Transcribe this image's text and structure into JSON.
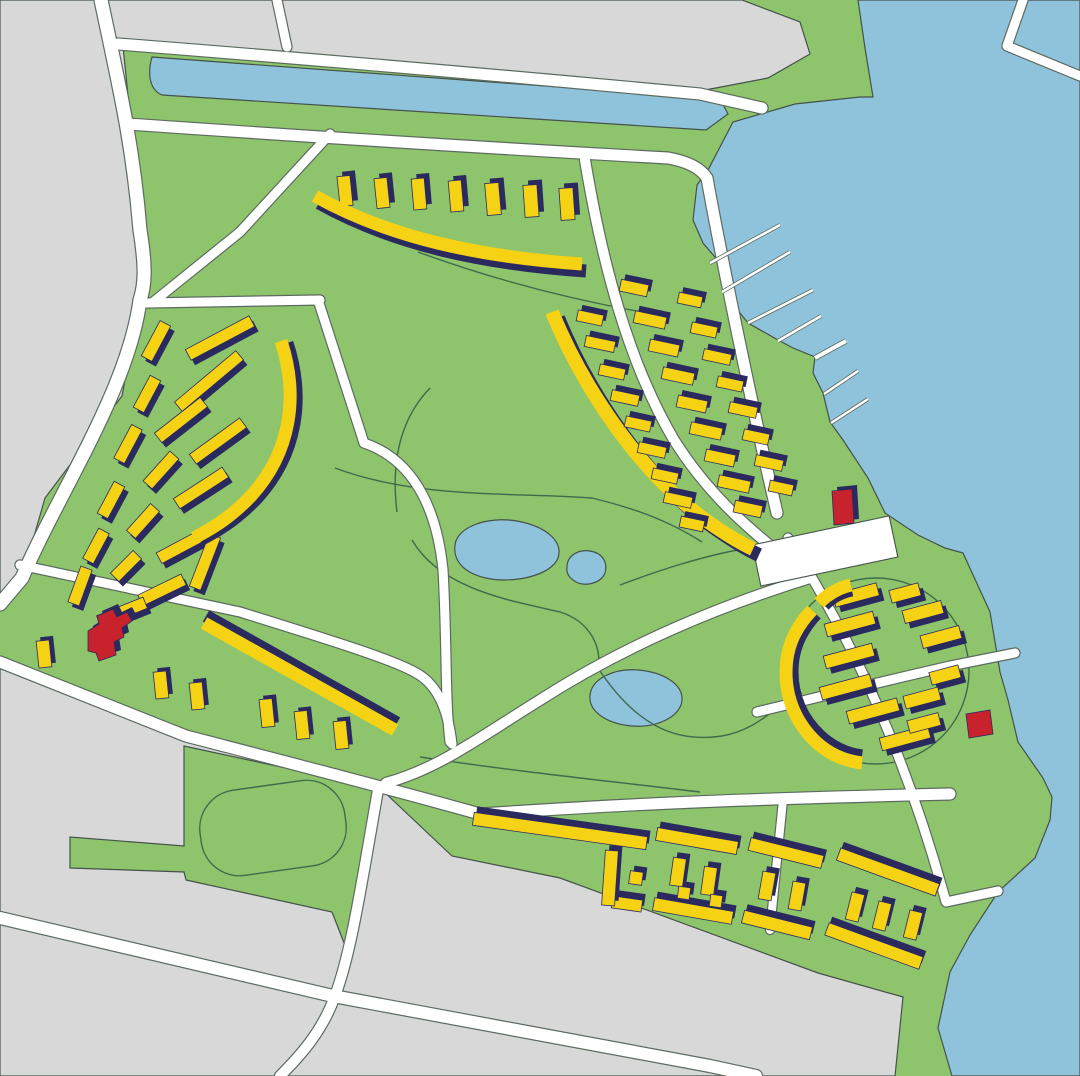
{
  "map": {
    "kind": "masterplan-illustration",
    "colors": {
      "parkland": "#8DC46C",
      "urban_block": "#D8D8D8",
      "water": "#8FC3DC",
      "road_fill": "#FFFFFF",
      "road_casing": "#5C6B5F",
      "outline": "#44524A",
      "trail": "#3F6B4D",
      "building_fill": "#F6D215",
      "building_shadow": "#2B2A5F",
      "landmark_red": "#C8232C",
      "plaza": "#FFFFFF"
    },
    "regions": {
      "urban_blocks": [
        "M0,0 L742,0 L800,22 L810,54 L768,78 L700,91 L123,46 L133,145 L141,240 L140,300 L122,396 L45,498 L22,578 L0,604 Z",
        "M967,0 L1080,0 L1080,162 Z",
        "M0,668 L186,738 L380,788 L452,856 L560,878 L818,973 L903,997 L895,1076 L0,1076 Z"
      ],
      "water_bodies": [
        "M858,0 L1080,0 L1080,1076 L952,1076 L938,1028 L950,972 L970,935 L998,892 L1035,858 L1050,820 L1052,797 L1043,778 L1018,742 L1008,700 L1000,672 L990,612 L963,553 L945,548 L918,535 L885,513 L868,478 L843,440 L830,422 L823,393 L813,373 L815,357 L793,348 L778,340 L748,323 L723,292 L720,263 L703,243 L693,220 L697,185 L708,170 L733,122 L795,104 L860,97 L873,97 L865,48 Z",
        "M152,57 L720,99 L728,114 L706,130 L162,95 C150,90 147,75 152,57 Z"
      ],
      "ponds": [
        "M455,545 C457,527 487,516 517,521 C549,527 563,543 558,558 C551,576 512,584 486,578 C463,573 453,560 455,545 Z",
        "M567,567 C567,556 578,549 590,551 C603,553 608,563 605,573 C601,583 586,587 576,582 C569,578 566,573 567,567 Z",
        "M590,695 C592,678 615,668 638,670 C663,672 683,684 682,700 C681,716 658,728 632,726 C608,724 588,712 590,695 Z"
      ],
      "track_field": "M184,746 L378,788 L360,884 L346,948 L332,912 L186,880 L184,872 L70,868 L70,837 L184,846 Z",
      "track_oval": {
        "cx": 273,
        "cy": 828,
        "rx": 73,
        "ry": 43,
        "rot": -8
      },
      "cluster_circle": {
        "cx": 876,
        "cy": 671,
        "r": 93
      }
    },
    "roads": [
      {
        "d": "M101,0 C120,90 133,145 140,230 C146,268 145,285 140,300 C128,390 60,490 22,578 L0,604",
        "w": 13
      },
      {
        "d": "M118,44 Q400,66 700,94 L762,108",
        "w": 11
      },
      {
        "d": "M128,124 Q400,143 668,158 Q697,163 707,178 C718,240 743,362 763,452 L777,513",
        "w": 11
      },
      {
        "d": "M277,0 L287,47",
        "w": 9
      },
      {
        "d": "M1023,0 L1007,46 L1080,76",
        "w": 9
      },
      {
        "d": "M330,134 L240,232 L152,303",
        "w": 9
      },
      {
        "d": "M146,303 L320,300",
        "w": 9
      },
      {
        "d": "M318,300 L364,443",
        "w": 9
      },
      {
        "d": "M364,443 C420,462 438,520 443,570 C447,640 445,700 450,742",
        "w": 9
      },
      {
        "d": "M20,565 L240,612 C330,640 395,660 418,674 C438,686 448,710 452,744",
        "w": 9
      },
      {
        "d": "M386,783 C440,768 480,737 540,700 C610,655 700,612 810,578",
        "w": 10
      },
      {
        "d": "M0,662 L186,736 C290,763 380,786 480,814 C600,806 700,800 950,794",
        "w": 11
      },
      {
        "d": "M378,790 C362,880 352,950 335,996 C322,1032 300,1056 280,1076",
        "w": 10
      },
      {
        "d": "M0,918 L333,996 L710,1066 L756,1076",
        "w": 12
      },
      {
        "d": "M788,538 C802,560 815,582 830,610 C865,672 910,770 946,902 L998,891",
        "w": 9
      },
      {
        "d": "M757,712 Q880,682 950,666 L1015,653",
        "w": 9
      },
      {
        "d": "M783,800 L770,930",
        "w": 8
      },
      {
        "d": "M585,160 C602,262 628,362 674,440 C708,494 748,528 778,552",
        "w": 10
      }
    ],
    "trails": [
      "M335,468 C420,500 520,492 592,498 C650,512 680,528 702,542",
      "M397,512 C390,455 404,415 430,388",
      "M412,540 C442,592 520,602 560,612 C592,622 602,650 598,668",
      "M598,668 C640,732 682,742 722,736 C760,729 775,705 802,693",
      "M620,585 C660,570 702,556 748,548",
      "M420,757 C520,772 600,780 700,792",
      "M418,252 C500,282 575,300 642,312"
    ],
    "piers": [
      {
        "x1": 710,
        "y1": 263,
        "x2": 780,
        "y2": 225,
        "w": 2.5
      },
      {
        "x1": 722,
        "y1": 292,
        "x2": 790,
        "y2": 252,
        "w": 2.5
      },
      {
        "x1": 748,
        "y1": 323,
        "x2": 813,
        "y2": 290,
        "w": 2.5
      },
      {
        "x1": 778,
        "y1": 341,
        "x2": 821,
        "y2": 316,
        "w": 2.5
      },
      {
        "x1": 815,
        "y1": 358,
        "x2": 846,
        "y2": 341,
        "w": 4
      },
      {
        "x1": 824,
        "y1": 394,
        "x2": 858,
        "y2": 371,
        "w": 2.5
      },
      {
        "x1": 831,
        "y1": 423,
        "x2": 868,
        "y2": 399,
        "w": 2.5
      }
    ],
    "plaza": {
      "cx": 825,
      "cy": 551,
      "w": 140,
      "h": 42,
      "rot": -12
    },
    "building_groups": [
      {
        "name": "north-towers",
        "kind": "rects",
        "dx": 5,
        "dy": -5,
        "rects": [
          [
            345,
            191,
            13,
            30,
            -6
          ],
          [
            382,
            193,
            13,
            30,
            -6
          ],
          [
            419,
            194,
            13,
            31,
            -5
          ],
          [
            456,
            196,
            13,
            31,
            -5
          ],
          [
            493,
            199,
            14,
            32,
            -5
          ],
          [
            531,
            201,
            14,
            32,
            -4
          ],
          [
            567,
            204,
            14,
            32,
            -4
          ]
        ]
      },
      {
        "name": "north-curved-slab",
        "kind": "dualpath",
        "w": 13,
        "shadow": "M319,203 C394,245 484,264 586,271",
        "main": "M315,196 C390,238 480,257 582,264"
      },
      {
        "name": "west-slabs",
        "kind": "rects",
        "dx": 4,
        "dy": 5,
        "rects": [
          [
            156,
            341,
            40,
            12,
            -62
          ],
          [
            220,
            338,
            72,
            12,
            -28
          ],
          [
            209,
            381,
            80,
            12,
            -40
          ],
          [
            147,
            394,
            36,
            12,
            -62
          ],
          [
            181,
            420,
            58,
            12,
            -38
          ],
          [
            218,
            441,
            62,
            12,
            -36
          ],
          [
            128,
            444,
            38,
            12,
            -62
          ],
          [
            161,
            470,
            40,
            12,
            -48
          ],
          [
            201,
            488,
            58,
            12,
            -33
          ],
          [
            111,
            500,
            36,
            12,
            -62
          ],
          [
            143,
            521,
            36,
            12,
            -48
          ],
          [
            182,
            546,
            52,
            12,
            -28
          ],
          [
            96,
            546,
            34,
            12,
            -62
          ],
          [
            126,
            566,
            32,
            12,
            -45
          ],
          [
            162,
            590,
            48,
            12,
            -26
          ],
          [
            80,
            586,
            38,
            12,
            -70
          ],
          [
            122,
            612,
            50,
            12,
            -22
          ],
          [
            205,
            562,
            56,
            12,
            -69
          ]
        ]
      },
      {
        "name": "west-curved-slab",
        "kind": "dualpath",
        "w": 13,
        "shadow": "M287,343 C305,398 297,454 257,498 C233,523 213,533 200,540",
        "main": "M281,341 C299,396 291,452 251,496 C227,521 207,531 194,538"
      },
      {
        "name": "west-towers",
        "kind": "rects",
        "dx": 4,
        "dy": -4,
        "rects": [
          [
            44,
            654,
            13,
            27,
            -6
          ],
          [
            161,
            685,
            13,
            27,
            -6
          ],
          [
            197,
            696,
            13,
            27,
            -6
          ],
          [
            267,
            713,
            13,
            28,
            -6
          ],
          [
            302,
            725,
            13,
            28,
            -6
          ],
          [
            341,
            735,
            13,
            28,
            -6
          ]
        ]
      },
      {
        "name": "west-long-slab",
        "kind": "dualpath",
        "w": 13,
        "shadow": "M206,616 L397,723",
        "main": "M204,623 L395,730"
      },
      {
        "name": "mid-curved-slab",
        "kind": "dualpath",
        "w": 14,
        "shadow": "M558,318 C591,398 646,476 706,522 C728,538 746,549 759,555",
        "main": "M552,312 C585,392 640,470 700,516 C722,532 740,543 753,549"
      },
      {
        "name": "mid-houses",
        "kind": "rects",
        "dx": 4,
        "dy": -5,
        "rects": [
          [
            590,
            318,
            26,
            11,
            12
          ],
          [
            600,
            344,
            30,
            11,
            12
          ],
          [
            612,
            372,
            26,
            11,
            12
          ],
          [
            625,
            398,
            28,
            11,
            12
          ],
          [
            638,
            424,
            26,
            11,
            12
          ],
          [
            652,
            450,
            28,
            11,
            12
          ],
          [
            665,
            476,
            26,
            11,
            12
          ],
          [
            678,
            500,
            28,
            11,
            12
          ],
          [
            692,
            524,
            24,
            11,
            12
          ],
          [
            634,
            288,
            28,
            12,
            12
          ],
          [
            650,
            320,
            32,
            12,
            12
          ],
          [
            664,
            348,
            30,
            12,
            12
          ],
          [
            678,
            376,
            32,
            12,
            12
          ],
          [
            692,
            404,
            30,
            12,
            12
          ],
          [
            706,
            431,
            32,
            12,
            12
          ],
          [
            720,
            458,
            30,
            12,
            12
          ],
          [
            734,
            484,
            32,
            12,
            12
          ],
          [
            748,
            509,
            28,
            12,
            12
          ],
          [
            690,
            300,
            24,
            11,
            12
          ],
          [
            704,
            330,
            26,
            11,
            12
          ],
          [
            717,
            357,
            28,
            11,
            12
          ],
          [
            730,
            384,
            26,
            11,
            12
          ],
          [
            743,
            410,
            28,
            11,
            12
          ],
          [
            756,
            437,
            26,
            11,
            12
          ],
          [
            769,
            463,
            28,
            11,
            12
          ],
          [
            781,
            488,
            24,
            11,
            12
          ]
        ]
      },
      {
        "name": "circle-houses",
        "kind": "rects",
        "dx": 5,
        "dy": 5,
        "rects": [
          [
            856,
            595,
            45,
            13,
            -15
          ],
          [
            905,
            593,
            30,
            13,
            -15
          ],
          [
            850,
            624,
            50,
            13,
            -15
          ],
          [
            923,
            612,
            40,
            13,
            -15
          ],
          [
            849,
            656,
            50,
            13,
            -15
          ],
          [
            941,
            637,
            40,
            13,
            -15
          ],
          [
            846,
            687,
            52,
            13,
            -15
          ],
          [
            945,
            675,
            30,
            13,
            -15
          ],
          [
            873,
            711,
            52,
            13,
            -15
          ],
          [
            922,
            698,
            36,
            13,
            -15
          ],
          [
            905,
            738,
            50,
            13,
            -15
          ],
          [
            924,
            723,
            32,
            13,
            -15
          ]
        ]
      },
      {
        "name": "circle-arc-slab-top",
        "kind": "dualpath",
        "w": 13,
        "shadow": "M852,590 C841,592 832,597 824,605",
        "main": "M851,585 C838,588 828,594 819,603"
      },
      {
        "name": "circle-arc-slab-main",
        "kind": "dualpath",
        "w": 13,
        "shadow": "M816,614 C799,632 792,651 792,671 C792,697 802,719 820,736 C833,748 847,754 862,756",
        "main": "M812,610 C793,630 786,650 786,672 C786,700 797,724 816,742 C830,755 845,761 862,763"
      },
      {
        "name": "south-slabs",
        "kind": "rects",
        "dx": 3,
        "dy": -6,
        "rects": [
          [
            560,
            831,
            175,
            13,
            8
          ],
          [
            627,
            904,
            30,
            12,
            8
          ],
          [
            697,
            841,
            82,
            13,
            10
          ],
          [
            693,
            911,
            80,
            13,
            10
          ],
          [
            786,
            853,
            75,
            13,
            14
          ],
          [
            777,
            925,
            70,
            13,
            14
          ],
          [
            888,
            872,
            105,
            13,
            20
          ],
          [
            874,
            946,
            100,
            13,
            20
          ]
        ]
      },
      {
        "name": "south-towers",
        "kind": "rects",
        "dx": 4,
        "dy": -5,
        "rects": [
          [
            610,
            878,
            13,
            55,
            4
          ],
          [
            636,
            878,
            13,
            13,
            8
          ],
          [
            678,
            872,
            13,
            28,
            8
          ],
          [
            709,
            881,
            13,
            28,
            8
          ],
          [
            684,
            893,
            12,
            12,
            8
          ],
          [
            716,
            901,
            12,
            12,
            8
          ],
          [
            767,
            886,
            13,
            28,
            10
          ],
          [
            797,
            896,
            13,
            28,
            10
          ],
          [
            855,
            907,
            13,
            28,
            14
          ],
          [
            882,
            916,
            13,
            28,
            14
          ],
          [
            913,
            925,
            13,
            28,
            14
          ]
        ]
      }
    ],
    "red_buildings": [
      {
        "name": "west-landmark",
        "dx": 5,
        "dy": -5,
        "d": "M88,631 L99,624 L97,616 L113,609 L117,617 L127,612 L132,621 L122,628 L124,637 L114,642 L116,655 L99,661 L96,653 L88,651 Z"
      },
      {
        "name": "harbor-landmark",
        "dx": 5,
        "dy": -4,
        "d": "M832,491 L852,489 L854,523 L834,525 Z"
      },
      {
        "name": "shore-landmark",
        "dx": 0,
        "dy": 0,
        "d": "M966,714 L990,710 L993,734 L969,738 Z"
      }
    ]
  }
}
